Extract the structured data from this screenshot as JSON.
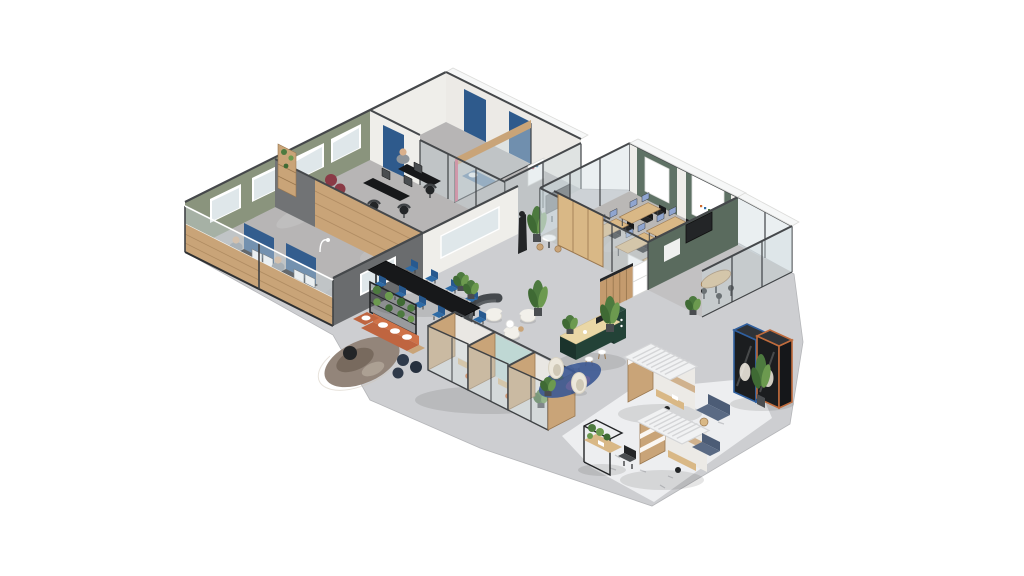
{
  "meta": {
    "title": "Isometric 3D office floor plan rendering on white background",
    "canvas_width": 1024,
    "canvas_height": 576,
    "people_visible": 3
  },
  "colors": {
    "background": "#ffffff",
    "floorOpen": "#cdced1",
    "floorBlock": "#b7b5b5",
    "floorTraining": "#bab8b6",
    "floorNook": "#c2c1c2",
    "floorPod": "#dad9d7",
    "rugZone": "#edeef0",
    "rugMark": "#c5c7ca",
    "wallGreen": "#8a947d",
    "wallGreenPanel": "#5f7265",
    "wallSage": "#5a6b5e",
    "wallWhite": "#efeeea",
    "wallCream": "#eceae6",
    "wallGray": "#6a6c6e",
    "wallGrayLight": "#717375",
    "wood": "#c49b6e",
    "woodWall": "#c9a478",
    "woodLight": "#d9b886",
    "woodPale": "#ead7a6",
    "woodDark": "#9a7850",
    "frame": "#3f4245",
    "cap": "#45484b",
    "glass": "rgba(206,218,222,0.42)",
    "glassSolid": "#dfe7ea",
    "navyPanel": "#2e5a8c",
    "chairBlue": "#2e6ba6",
    "chairBlueDark": "#27598f",
    "laptopBlue": "#8fa5d0",
    "black": "#17181a",
    "charcoal": "#232527",
    "darkGray": "#4a4d50",
    "midGray": "#585c5e",
    "burgundy": "#8a3a46",
    "terracotta": "#bf6540",
    "terracottaLight": "#cf7248",
    "rugBrown": "#93857a",
    "rugBrownDark": "#6f6156",
    "rugBrownLight": "#b7ab9e",
    "plantGreen": "#4d7a3f",
    "plantLight": "#6c9a4f",
    "plantDark": "#3f6a34",
    "islandGreen": "#234237",
    "islandGreenDark": "#1b332c",
    "islandGreenTop": "#2c4f42",
    "cream": "#f2f0ea",
    "eggshell": "#ece7db",
    "eggOpen": "#cfc8b6",
    "poufNavy": "#2f3a4a",
    "copper": "#bf6b3c",
    "boothNavy": "#2f5f9e",
    "boothBody": "#1b1d1f",
    "boothSide": "#15171a",
    "boothTop": "#2f3338",
    "sofaBlue": "#5a6a84",
    "sofaBlueDark": "#4c5c76",
    "slatRoof": "#f1f2f3",
    "slatLine": "#d4d5d7",
    "ceiling": "#f6f7f7",
    "skin": "#d9b08c",
    "shirt": "#8f959b",
    "teal": "#bfd8d4",
    "orangeChair": "#cf6b2e",
    "pinkAccent": "#d4617e",
    "blueRug": "#3e5a94",
    "purpleRug": "#7a68a0",
    "shadow": "rgba(40,42,45,0.12)",
    "whiteSolid": "#ffffff"
  },
  "zones": [
    {
      "id": "private-office-upper",
      "label": "Private office with black desk cluster",
      "key_items": [
        "black desks",
        "office chairs",
        "burgundy poufs",
        "wood shelf",
        "green wall with windows"
      ]
    },
    {
      "id": "private-office-lower",
      "label": "Private office with dual-monitor workstations",
      "key_items": [
        "two workstations",
        "blue privacy panels",
        "seated people",
        "wood and glass front wall"
      ]
    },
    {
      "id": "focus-rooms",
      "label": "Focus rooms with blue daybed",
      "key_items": [
        "blue daybed",
        "glass partitions",
        "navy door panels",
        "white shelf"
      ]
    },
    {
      "id": "corridor",
      "label": "Corridor with presentation board",
      "key_items": [
        "TV board on stand",
        "black coat rack",
        "bistro table with wood stools",
        "tall plant"
      ]
    },
    {
      "id": "training-room",
      "label": "Training room",
      "key_items": [
        "six wood tables",
        "black chairs",
        "blue laptop screens",
        "green panel wall with whiteboards",
        "glass walls",
        "wood sliding door"
      ]
    },
    {
      "id": "high-table-nook",
      "label": "Glass nook with high table",
      "key_items": [
        "kidney-shaped wood high table",
        "black bar stools",
        "sage partition with TV"
      ]
    },
    {
      "id": "kitchen",
      "label": "Kitchenette",
      "key_items": [
        "dark green island with wood counter",
        "white stools",
        "wood slat wall",
        "white fridge cabinet"
      ]
    },
    {
      "id": "lounge-white",
      "label": "Lounge seating",
      "key_items": [
        "white armchairs",
        "curved dark partition",
        "round side tables",
        "tall plant"
      ]
    },
    {
      "id": "cocoon-corner",
      "label": "Cocoon chair corner",
      "key_items": [
        "two woven cocoon chairs",
        "blue organic rug"
      ]
    },
    {
      "id": "meeting-table",
      "label": "Long meeting table",
      "key_items": [
        "black conference table",
        "nine blue chairs",
        "potted plants"
      ]
    },
    {
      "id": "sofa-lounge",
      "label": "Sofa lounge",
      "key_items": [
        "terracotta L-sofa with white cushions",
        "plant partition wall",
        "round mottled rug",
        "navy poufs"
      ]
    },
    {
      "id": "phone-booths-center",
      "label": "Phone booth pods",
      "key_items": [
        "three wood and glass pods",
        "orange stools",
        "teal interior"
      ]
    },
    {
      "id": "phone-booths-right",
      "label": "Acoustic phone booths",
      "key_items": [
        "navy-framed booth",
        "copper-framed booth",
        "tall plant"
      ]
    },
    {
      "id": "pergola-pods",
      "label": "Pergola work pods on light rug",
      "key_items": [
        "two slat-roof pods",
        "blue-gray corner sofas",
        "plant cart workstation",
        "desk chair"
      ]
    }
  ]
}
